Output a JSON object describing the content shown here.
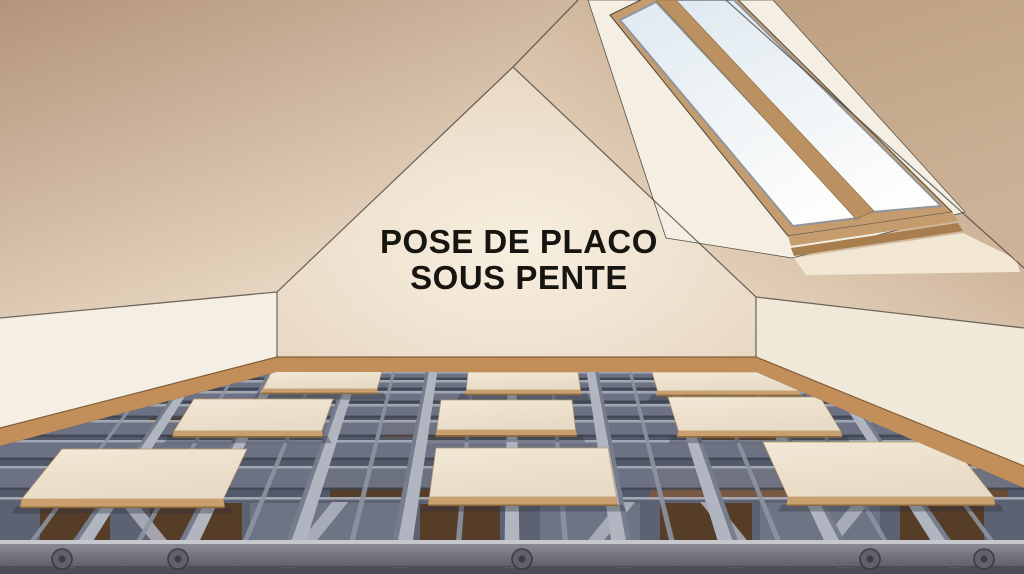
{
  "scene": {
    "description": "3D illustration of an attic room with sloped ceilings, a wooden roof window, and a metal floor framing grid with drywall panels",
    "title": {
      "line1": "POSE DE PLACO",
      "line2": "SOUS PENTE",
      "color": "#17150f"
    }
  },
  "palette": {
    "slope_left_dark": "#b3947a",
    "slope_left_light": "#ecdcc8",
    "slope_right_dark": "#b89a7d",
    "slope_right_light": "#eddcc6",
    "end_wall_dark": "#bda080",
    "end_wall_light": "#cdb298",
    "gable_center": "#f8efe0",
    "gable_edge": "#e2d0ba",
    "knee_wall_left": "#f4eee3",
    "knee_wall_right": "#f0e8d8",
    "baseboard": "#c28e59",
    "baseboard_dark": "#9c7240",
    "window_frame": "#c49c6e",
    "window_frame_dark": "#a87e4e",
    "mullion": "#bb9161",
    "glass_top": "#dfe9f1",
    "glass_bottom": "#fdfdfb",
    "sash": "#8f969e",
    "well": "#f5efe3",
    "sill_light": "#f2e7d2",
    "floor_base": "#525968",
    "back_shadow": "#474c59",
    "joist_flange": "#b0b5c0",
    "joist_side": "#767d8c",
    "joist_secondary": "#8d93a2",
    "cross_light": "#a6acb8",
    "cross_face": "#6d7484",
    "slot_dark": "#3e4350",
    "wood_dark": "#563d28",
    "wood_mid": "#6b4b31",
    "wood_light": "#7a5840",
    "panel_face": "#f2e8d6",
    "panel_face2": "#e8dbc5",
    "panel_edge": "#c89f6d",
    "panel_edge_dark": "#8e6b3f",
    "front_band": "#5c6271",
    "beam_lip": "#c7c8ce",
    "beam_top": "#8a8a93",
    "beam_bottom": "#5f5f68",
    "beam_base": "#4c4c55",
    "bolt": "#61616a",
    "bolt_dark": "#3c3c44",
    "outline": "#4c463e"
  },
  "floor": {
    "panel_count": 9,
    "panels": [
      {
        "x0": 272,
        "x1": 382,
        "y0": 371,
        "y1": 389
      },
      {
        "x0": 468,
        "x1": 578,
        "y0": 372,
        "y1": 390
      },
      {
        "x0": 652,
        "x1": 788,
        "y0": 372,
        "y1": 391
      },
      {
        "x0": 194,
        "x1": 333,
        "y0": 399,
        "y1": 431
      },
      {
        "x0": 441,
        "x1": 572,
        "y0": 400,
        "y1": 430
      },
      {
        "x0": 668,
        "x1": 820,
        "y0": 397,
        "y1": 431
      },
      {
        "x0": 62,
        "x1": 247,
        "y0": 449,
        "y1": 499
      },
      {
        "x0": 436,
        "x1": 608,
        "y0": 448,
        "y1": 497
      },
      {
        "x0": 763,
        "x1": 950,
        "y0": 442,
        "y1": 497
      }
    ],
    "bolts": [
      62,
      178,
      522,
      870,
      984
    ]
  },
  "window": {
    "pane_count": 2
  }
}
